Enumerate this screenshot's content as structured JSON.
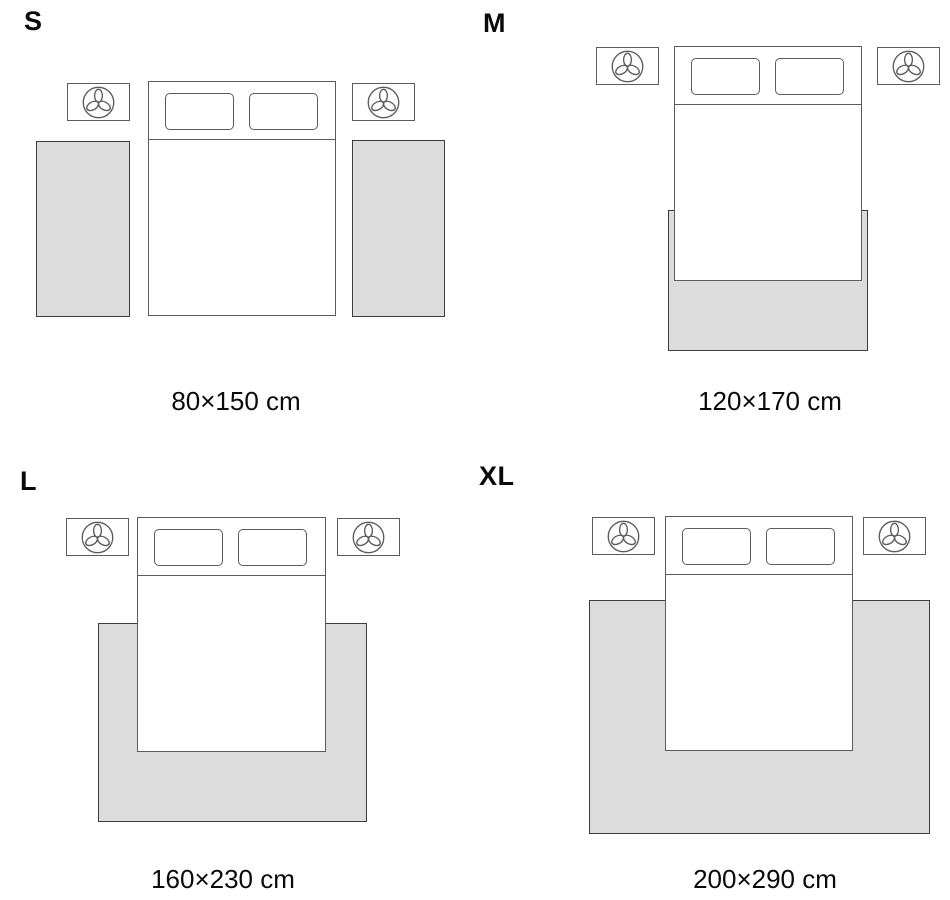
{
  "page": {
    "title": "Rug size guide"
  },
  "colors": {
    "background": "#ffffff",
    "rug_fill": "#dcdcdc",
    "rug_outline": "#3c3c3c",
    "furniture_outline": "#5c5c5c",
    "text": "#0a0a0a"
  },
  "icons": {
    "nightstand_icon": "plant-icon"
  },
  "sizes": [
    {
      "id": "S",
      "label": "S",
      "dimensions": "80×150 cm"
    },
    {
      "id": "M",
      "label": "M",
      "dimensions": "120×170 cm"
    },
    {
      "id": "L",
      "label": "L",
      "dimensions": "160×230 cm"
    },
    {
      "id": "XL",
      "label": "XL",
      "dimensions": "200×290 cm"
    }
  ]
}
